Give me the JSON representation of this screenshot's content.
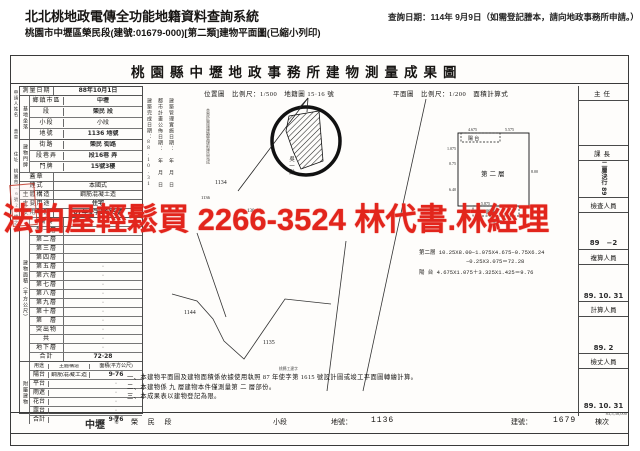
{
  "header": {
    "system_title": "北北桃地政電傳全功能地籍資料查詢系統",
    "query_date": "查詢日期：114年 9月9日（如需登記謄本，請向地政事務所申請。）",
    "subtitle": "桃園市中壢區榮民段(建號:01679-000)[第二類]建物平面圖(已縮小列印)"
  },
  "colors": {
    "watermark_red": "#e2251c",
    "stamp_red": "#c0392b",
    "ink": "#171513"
  },
  "watermark": {
    "text": "法拍屋輕鬆買 2266-3524 林代書.林經理"
  },
  "doc": {
    "title": "桃園縣中壢地政事務所建物測量成果圖",
    "side": {
      "applicant": "申請人姓名",
      "seal": "蓋章",
      "addr_label": "住址",
      "addr": "桃園市…6號20樓之1",
      "stamp": "印"
    },
    "app": {
      "survey_label": "測量日期",
      "survey_date": "88年10月1日"
    },
    "site": {
      "group": "基地坐落",
      "rows": [
        {
          "label": "鄉鎮市區",
          "value": "中壢"
        },
        {
          "label": "段",
          "value": "榮民 段"
        },
        {
          "label": "小段",
          "value": "小段"
        },
        {
          "label": "地號",
          "value": "1136 地號"
        }
      ]
    },
    "addr": {
      "group": "建物門牌",
      "rows": [
        {
          "label": "街路",
          "value": "榮民 街路"
        },
        {
          "label": "段巷弄",
          "value": "段16巷 弄"
        },
        {
          "label": "門牌",
          "value": "15號3樓"
        }
      ]
    },
    "seal_label": "蓋章",
    "build": {
      "rows": [
        {
          "label": "建式",
          "value": "本國式"
        },
        {
          "label": "主體構造",
          "value": "鋼筋混凝土造"
        },
        {
          "label": "主要用途",
          "value": "住宅"
        },
        {
          "label": "使用執照",
          "value": "87年使字1615號"
        }
      ]
    },
    "floors_group": "建物面積（平方公尺）",
    "floors": [
      {
        "label": "騎樓",
        "value": "·"
      },
      {
        "label": "第一層",
        "value": ""
      },
      {
        "label": "第二層",
        "value": ""
      },
      {
        "label": "第三層",
        "value": ""
      },
      {
        "label": "第四層",
        "value": ""
      },
      {
        "label": "第五層",
        "value": "·"
      },
      {
        "label": "第六層",
        "value": "·"
      },
      {
        "label": "第七層",
        "value": "·"
      },
      {
        "label": "第八層",
        "value": "·"
      },
      {
        "label": "第九層",
        "value": "·"
      },
      {
        "label": "第十層",
        "value": "·"
      },
      {
        "label": "第　層",
        "value": "·"
      },
      {
        "label": "突出物",
        "value": "·"
      },
      {
        "label": "共",
        "value": "·"
      },
      {
        "label": "地下層",
        "value": "·"
      },
      {
        "label": "合計",
        "value": "72·28"
      }
    ],
    "attach_group": "附屬建物",
    "attach_header": {
      "use": "用途",
      "structure": "主體構造",
      "area": "面積(平方公尺)"
    },
    "attached": [
      {
        "label": "陽台",
        "structure": "鋼筋混凝土造",
        "area": "9·76"
      },
      {
        "label": "平台",
        "structure": "",
        "area": "·"
      },
      {
        "label": "雨遮",
        "structure": "",
        "area": "·"
      },
      {
        "label": "花台",
        "structure": "",
        "area": "·"
      },
      {
        "label": "露台",
        "structure": "",
        "area": "·"
      },
      {
        "label": "合計",
        "structure": "",
        "area": "9·76"
      }
    ],
    "map": {
      "loc_header": "位置圖　比例尺：1/500　地籍圖 15·16 號",
      "plan_header": "平面圖　比例尺：1/200　面積計算式",
      "date_col_1": "建築完成日期：88.10.31",
      "date_col_2": "都市計畫公佈日期：　年　月　日",
      "date_col_3": "建築管理實施日期：　年　月　日",
      "stamp_note": "本案於實施建築管理前建造完成",
      "stamp_no": "1136",
      "owner": "吳一勳",
      "parcel_1134": "1134",
      "parcel_1144": "1144",
      "parcel_1135": "1135",
      "parcel_13016": "130-16"
    },
    "plan": {
      "room": "第二層",
      "balcony_top": "陽 台",
      "balcony_bottom": "陽 台",
      "dim_top_left": "4.675",
      "dim_top_right": "5.575",
      "dim_left_1": "1.075",
      "dim_left_2": "0.75",
      "dim_left_3": "6.40",
      "dim_right": "8.00",
      "dim_bot_1": "0.35",
      "dim_bot_2": "5.875",
      "dim_bot_3": "3.335",
      "calc_l1": "第二層 10.25X8.00−1.075X4.675−0.75X6.24",
      "calc_l2": "−0.25X3.075＝72.28",
      "calc_l3": "陽 台 4.675X1.075＋3.325X1.425＝9.76"
    },
    "officials": [
      {
        "title": "主任",
        "note": ""
      },
      {
        "title": "課長",
        "note": "二層決行 89"
      },
      {
        "title": "檢查人員",
        "note": "89　−2"
      },
      {
        "title": "複算人員",
        "note": "89. 10. 31"
      },
      {
        "title": "計算人員",
        "note": "89. 2"
      },
      {
        "title": "檢丈人員",
        "note": "89. 10. 31"
      }
    ],
    "form_no": "83,5,38,000",
    "notes": {
      "annotation": "桃縣工建字",
      "line1": "一、本建物平面圖及建物面積係依據使用執照 87 年使字第 1615 號設計圖或竣工平面圖轉繪計算。",
      "line2": "二、本建物係 九 層建物本件僅測量第 二 層部份。",
      "line3": "三、本成果表以建物登記為限。"
    },
    "footer": {
      "town": "中壢",
      "town_label": "鄉市",
      "section": "榮 民 段",
      "subsection": "小段",
      "parcel_label": "地號：",
      "parcel": "1136",
      "building_label": "建號：",
      "building_no": "1679",
      "unit_label": "棟次"
    }
  }
}
